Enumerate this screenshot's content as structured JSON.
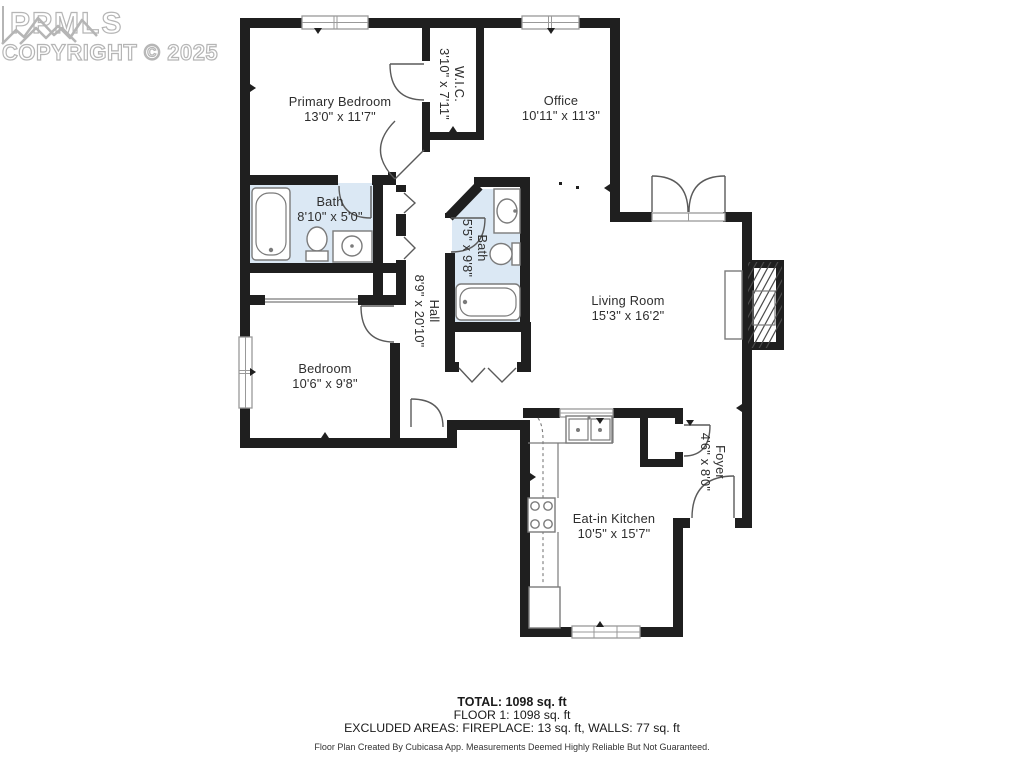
{
  "watermark": {
    "logo_text": "PPMLS",
    "copyright": "COPYRIGHT © 2025"
  },
  "rooms": [
    {
      "name": "Primary Bedroom",
      "dims": "13'0\" x 11'7\""
    },
    {
      "name": "W.I.C.",
      "dims": "3'10\" x 7'11\""
    },
    {
      "name": "Office",
      "dims": "10'11\" x 11'3\""
    },
    {
      "name": "Bath",
      "dims": "8'10\" x 5'0\""
    },
    {
      "name": "Bath",
      "dims": "5'5\" x 9'8\""
    },
    {
      "name": "Hall",
      "dims": "8'9\" x 20'10\""
    },
    {
      "name": "Living Room",
      "dims": "15'3\" x 16'2\""
    },
    {
      "name": "Bedroom",
      "dims": "10'6\" x 9'8\""
    },
    {
      "name": "Eat-in Kitchen",
      "dims": "10'5\" x 15'7\""
    },
    {
      "name": "Foyer",
      "dims": "4'6\" x 8'0\""
    }
  ],
  "summary": {
    "total": "TOTAL: 1098 sq. ft",
    "floor": "FLOOR 1: 1098 sq. ft",
    "excluded": "EXCLUDED AREAS: FIREPLACE: 13 sq. ft, WALLS: 77 sq. ft",
    "disclaimer": "Floor Plan Created By Cubicasa App. Measurements Deemed Highly Reliable But Not Guaranteed."
  },
  "colors": {
    "wall": "#1f1f1f",
    "bath_fill": "#dbe8f4",
    "fixture": "#7b7b7b",
    "door": "#5a5a5a",
    "label": "#2e2e2e",
    "watermark": "#b5b5b5",
    "summary_text": "#1a1a1a"
  }
}
